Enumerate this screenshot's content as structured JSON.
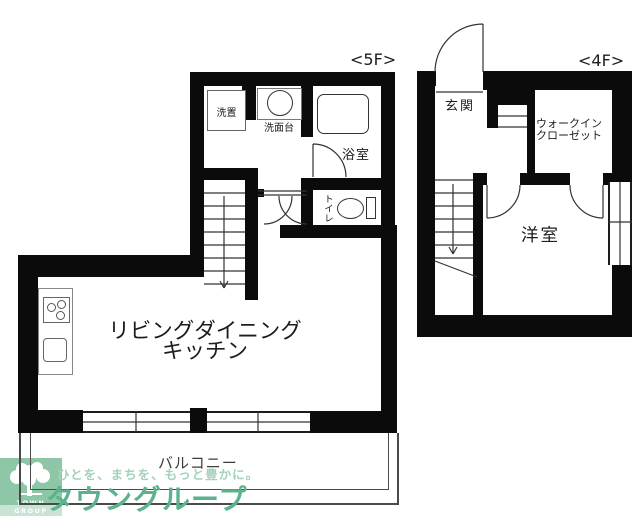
{
  "plan": {
    "floor5": {
      "floor_tag": "<5F>",
      "rooms": {
        "washer": "洗置",
        "vanity": "洗面台",
        "bath": "浴室",
        "toilet": "トイレ",
        "ldk_line1": "リビングダイニング",
        "ldk_line2": "キッチン",
        "balcony": "バルコニー"
      }
    },
    "floor4": {
      "floor_tag": "<4F>",
      "rooms": {
        "entrance": "玄関",
        "wic_line1": "ウォークイン",
        "wic_line2": "クローゼット",
        "western_room": "洋室"
      }
    }
  },
  "logo": {
    "tagline": "ひとを、まちを、もっと豊かに。",
    "brand": "タウングループ",
    "brand_en": "TOWN GROUP"
  },
  "colors": {
    "wall": "#0b0b0b",
    "logo_green": "#8ec7a7",
    "logo_green_light": "#c9e3d4",
    "brand_green": "#5bb28c",
    "tagline_green": "#a3d2b9"
  }
}
